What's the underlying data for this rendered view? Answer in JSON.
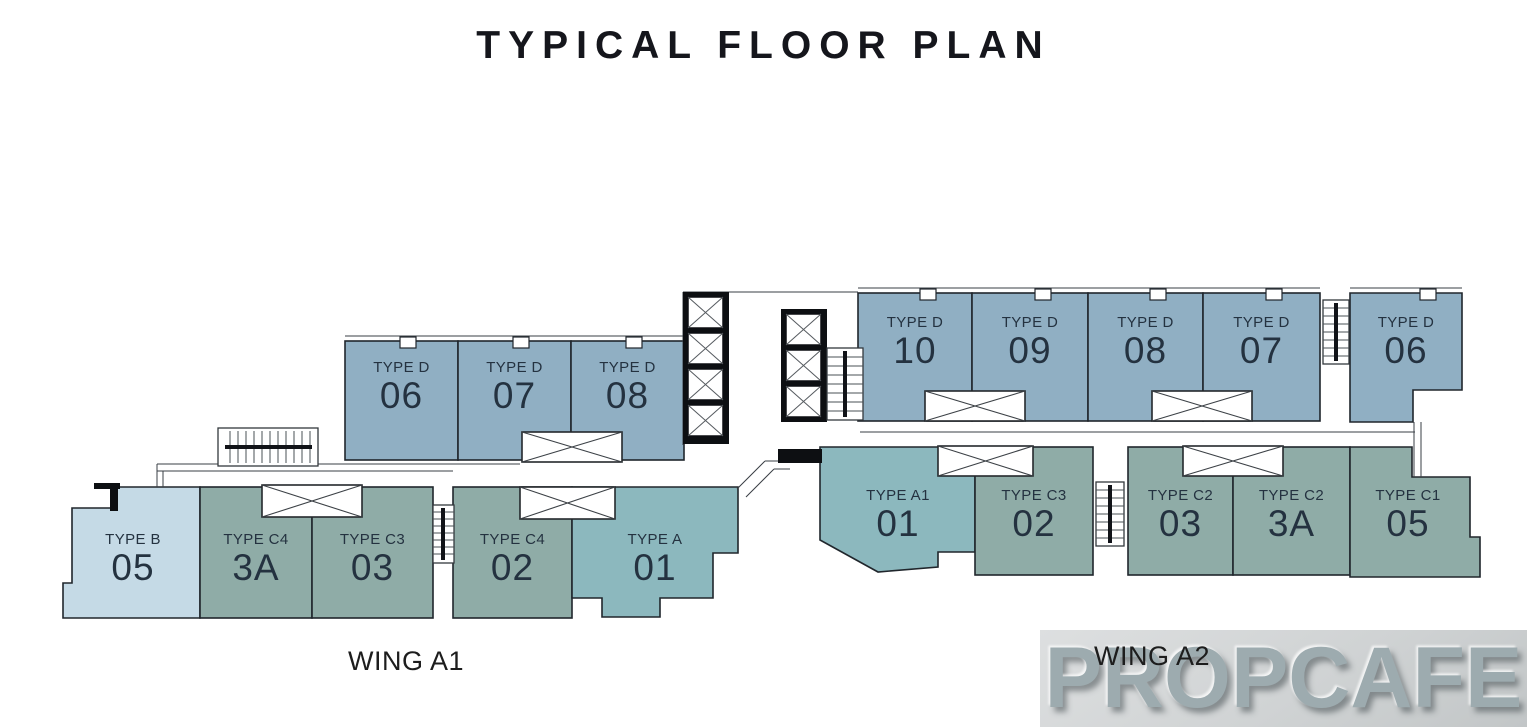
{
  "title": "TYPICAL FLOOR PLAN",
  "palette": {
    "type_d": "#90AFC3",
    "type_c": "#8FACA7",
    "type_a": "#8CB8BE",
    "type_b": "#C5DAE6",
    "outline": "#20262C",
    "label": "#243240"
  },
  "wings": {
    "a1": "WING A1",
    "a2": "WING A2"
  },
  "watermark": "PROPCAFE",
  "units": {
    "a1_d06": {
      "type": "TYPE D",
      "num": "06"
    },
    "a1_d07": {
      "type": "TYPE D",
      "num": "07"
    },
    "a1_d08": {
      "type": "TYPE D",
      "num": "08"
    },
    "a1_b05": {
      "type": "TYPE B",
      "num": "05"
    },
    "a1_c4_3a": {
      "type": "TYPE C4",
      "num": "3A"
    },
    "a1_c3_03": {
      "type": "TYPE C3",
      "num": "03"
    },
    "a1_c4_02": {
      "type": "TYPE C4",
      "num": "02"
    },
    "a1_a_01": {
      "type": "TYPE A",
      "num": "01"
    },
    "a2_d10": {
      "type": "TYPE D",
      "num": "10"
    },
    "a2_d09": {
      "type": "TYPE D",
      "num": "09"
    },
    "a2_d08": {
      "type": "TYPE D",
      "num": "08"
    },
    "a2_d07": {
      "type": "TYPE D",
      "num": "07"
    },
    "a2_d06": {
      "type": "TYPE D",
      "num": "06"
    },
    "a2_a1_01": {
      "type": "TYPE A1",
      "num": "01"
    },
    "a2_c3_02": {
      "type": "TYPE C3",
      "num": "02"
    },
    "a2_c2_03": {
      "type": "TYPE C2",
      "num": "03"
    },
    "a2_c2_3a": {
      "type": "TYPE C2",
      "num": "3A"
    },
    "a2_c1_05": {
      "type": "TYPE C1",
      "num": "05"
    }
  }
}
